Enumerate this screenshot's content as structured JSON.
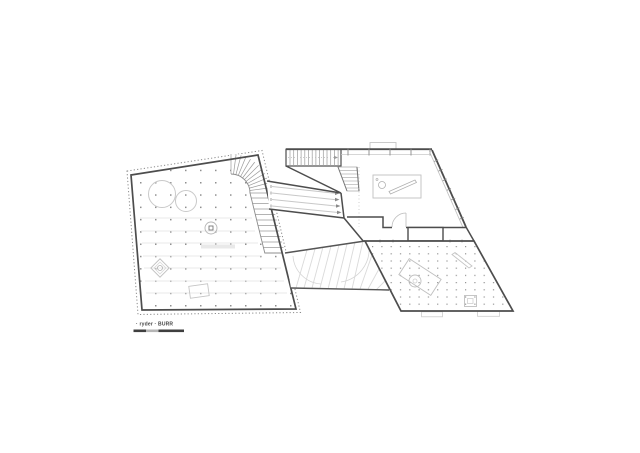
{
  "branding": {
    "label": "· ryder · BURR"
  },
  "colors": {
    "background": "#ffffff",
    "wall": "#4d4d4d",
    "light_line": "#c8c8c8",
    "faint_line": "#e2e2e2",
    "grid_dot": "#8f8f8f",
    "hatch": "#dadada",
    "stair_tread": "#9a9a9a",
    "dashed_boundary": "#8a8a8a",
    "scale_bar_dark": "#3f3f3f",
    "scale_bar_light": "#b5b5b5",
    "brand_text": "#444444"
  }
}
